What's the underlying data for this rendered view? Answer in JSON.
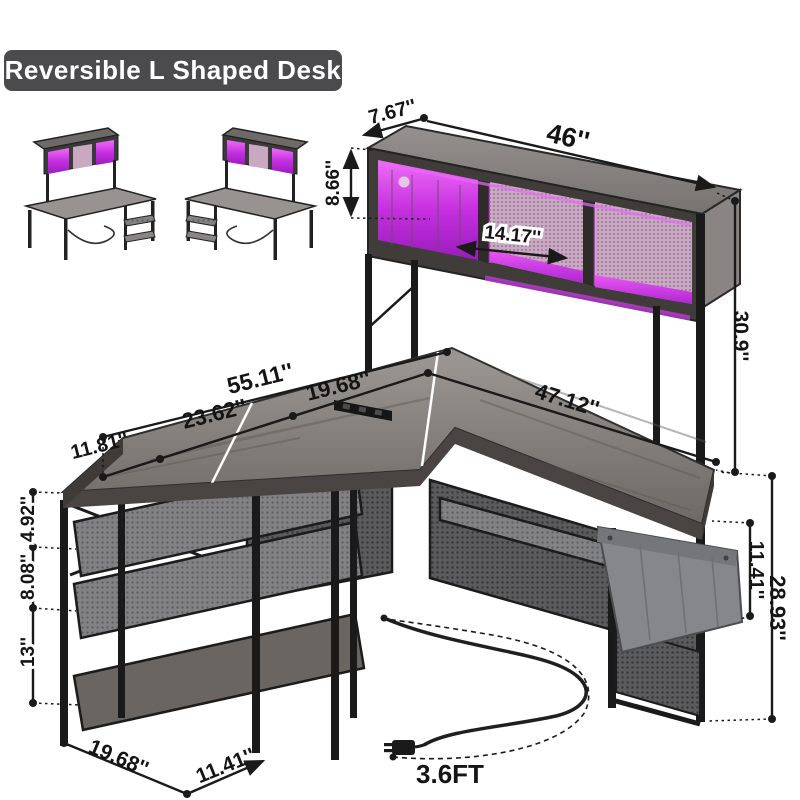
{
  "title": "Reversible L Shaped Desk",
  "dims": {
    "hutch_top_depth": "7.67''",
    "hutch_width": "46''",
    "hutch_height": "8.66''",
    "cubby_width": "14.17''",
    "hutch_to_desk": "30.9''",
    "total_length": "55.11''",
    "left_segment": "11.81''",
    "middle_segment": "23.62''",
    "corner_segment": "19.68''",
    "main_desk_length": "47.12''",
    "gap_desk_to_shelf1": "4.92''",
    "gap_shelf1_to_shelf2": "8.08''",
    "gap_shelf2_to_bottom": "13''",
    "pocket_height": "11.41''",
    "desk_height": "28.93''",
    "base_depth": "19.68''",
    "base_shelf_width": "11.41''",
    "cord_length": "3.6FT"
  },
  "colors": {
    "led_purple": "#c43ae0",
    "wood_gray": "#7b7674",
    "frame_black": "#1a1a1a",
    "badge_bg": "#4b4b4d",
    "mesh_gray": "#5a5a5c",
    "pocket_gray": "#85878a",
    "dimension_ink": "#141414",
    "background": "#ffffff"
  }
}
